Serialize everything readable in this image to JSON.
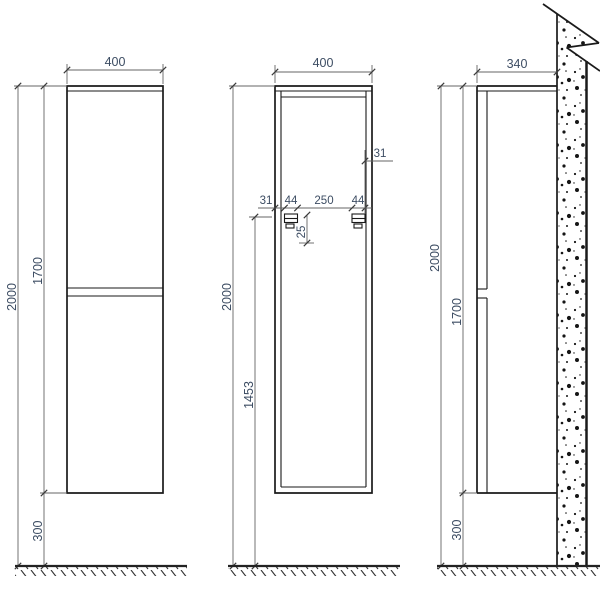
{
  "drawing": {
    "colors": {
      "outline": "#1a1a1a",
      "dimension_line": "#646464",
      "dimension_text": "#3d4d63",
      "background": "#ffffff"
    },
    "views": {
      "front": {
        "width": "400",
        "overall_height": "2000",
        "cabinet_height": "1700",
        "floor_clearance": "300"
      },
      "rear": {
        "width": "400",
        "overall_height": "2000",
        "rail_height_from_floor": "1453",
        "bracket_offset_left": "31",
        "bracket_offset_right": "31",
        "bracket_width_left": "44",
        "bracket_spacing": "250",
        "bracket_width_right": "44",
        "bracket_drop": "25"
      },
      "side": {
        "depth": "340",
        "overall_height": "2000",
        "cabinet_height": "1700",
        "floor_clearance": "300"
      }
    }
  }
}
